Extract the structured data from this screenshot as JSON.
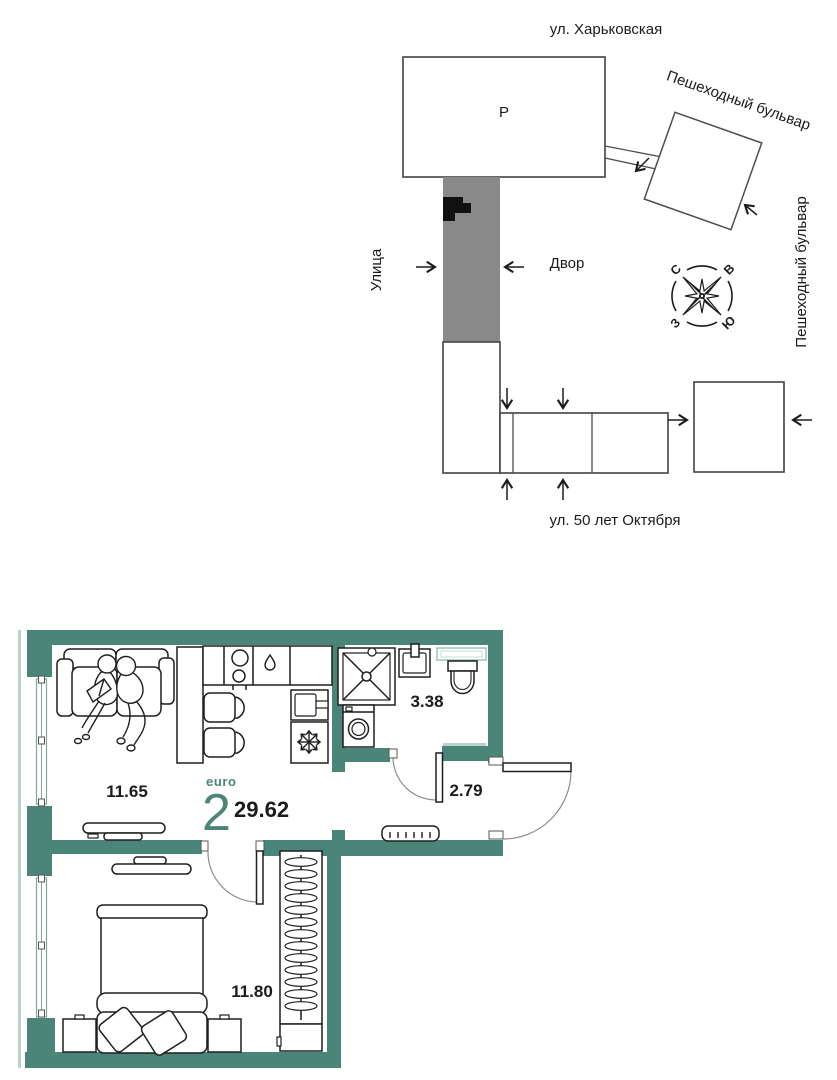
{
  "site_plan": {
    "street_top": "ул. Харьковская",
    "boulevard_diagonal": "Пешеходный бульвар",
    "boulevard_right": "Пешеходный бульвар",
    "street_left": "Улица",
    "courtyard_label": "Двор",
    "street_bottom": "ул. 50 лет Октября",
    "parking_label": "Р",
    "compass": {
      "north": "С",
      "east": "В",
      "west": "З",
      "south": "Ю"
    }
  },
  "apartment": {
    "type_label": "euro",
    "rooms_label": "2",
    "total_area": "29.62",
    "living_area": "11.65",
    "bathroom_area": "3.38",
    "hallway_area": "2.79",
    "bedroom_area": "11.80"
  },
  "colors": {
    "wall_teal": "#4a8578",
    "accent_teal": "#4a8578",
    "building_gray": "#898989",
    "light_teal": "#b7d3cc",
    "ink": "#1b1b1b",
    "site_outline": "#4d4d4d"
  }
}
